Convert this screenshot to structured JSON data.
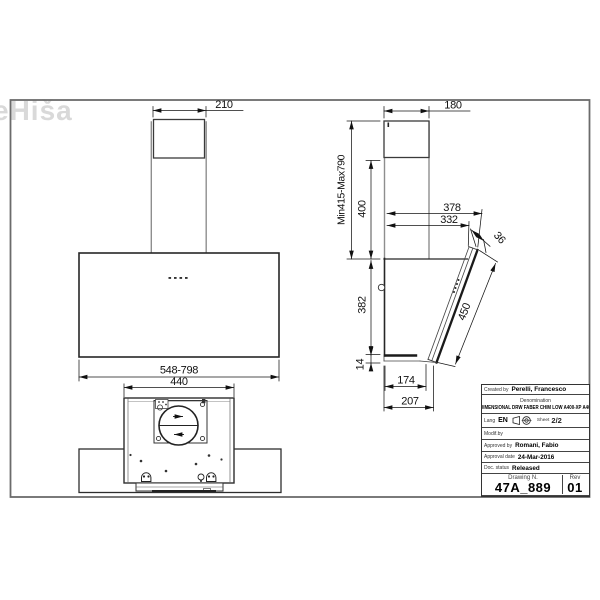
{
  "watermark": "eHiša",
  "front_view": {
    "dim_chimney_width": "210",
    "dim_body_width": "548-798",
    "dim_bottom_width": "440"
  },
  "side_view": {
    "dim_depth": "180",
    "dim_height_range": "Min415-Max790",
    "dim_chimney_height": "400",
    "dim_top_depth": "378",
    "dim_glass_top_depth": "332",
    "dim_glass_edge": "36",
    "dim_body_height": "382",
    "dim_glass_length": "450",
    "dim_bottom_lip": "14",
    "dim_bottom_depth": "174",
    "dim_total_bottom_depth": "207"
  },
  "title_block": {
    "created_by_label": "Created by",
    "created_by": "Perelli, Francesco",
    "denomination_label": "Denomination",
    "denomination": "DIMENSIONAL DRW FABER CHIM LOW A400-XP A400",
    "lang_label": "Lang",
    "lang": "EN",
    "sheet_label": "Sheet",
    "sheet": "2/2",
    "modif_label": "Modif.by",
    "approved_label": "Approved by",
    "approved_by": "Romani, Fabio",
    "approval_date_label": "Approval date",
    "approval_date": "24-Mar-2016",
    "doc_status_label": "Doc. status",
    "doc_status": "Released",
    "drawing_n_label": "Drawing N.",
    "drawing_n": "47A_889",
    "rev_label": "Rev",
    "rev": "01"
  },
  "colors": {
    "line_dark": "#222222",
    "line_gray": "#8e8e8e",
    "frame": "#6b6b6b",
    "watermark": "#d9d9d9"
  }
}
